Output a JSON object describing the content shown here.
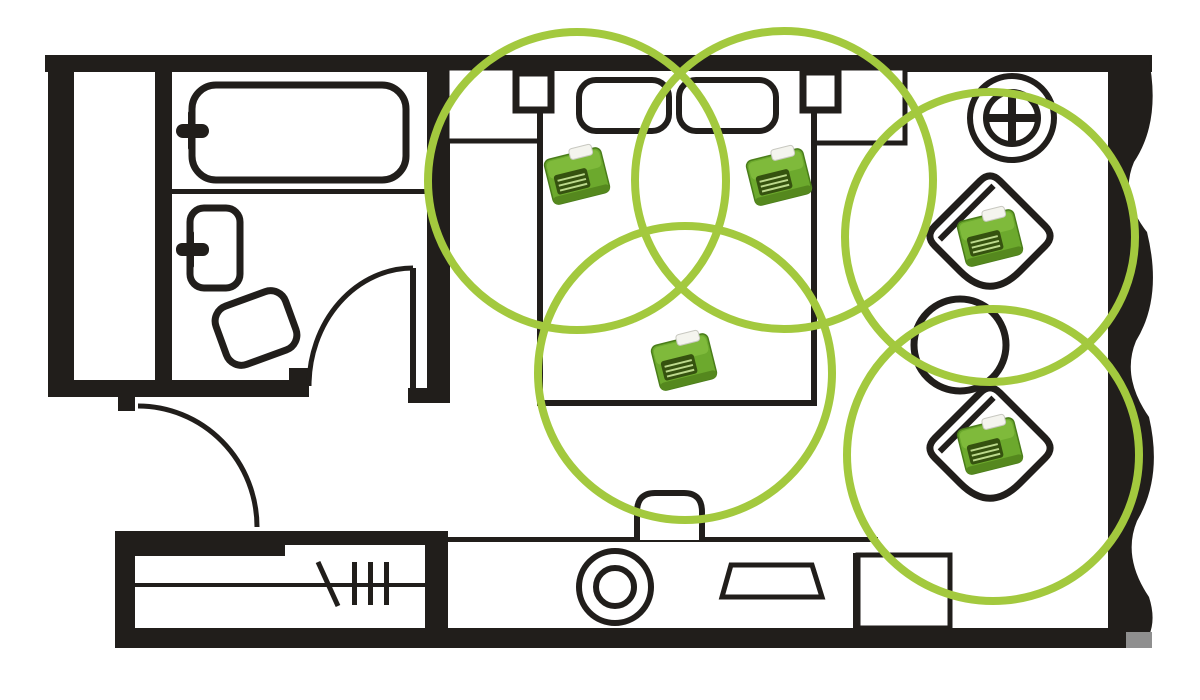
{
  "meta": {
    "kind": "floorplan-sensor-coverage-diagram"
  },
  "colors": {
    "background": "#ffffff",
    "wall": "#211e1b",
    "line": "#211e1b",
    "coverage": "#a3c93e",
    "shadow": "#8f8f8f"
  },
  "floorplan": {
    "walls": [
      {
        "name": "wall-top",
        "x": 45,
        "y": 55,
        "w": 1107,
        "h": 17
      },
      {
        "name": "wall-left",
        "x": 48,
        "y": 55,
        "w": 26,
        "h": 342
      },
      {
        "name": "wall-closet-inner",
        "x": 155,
        "y": 70,
        "w": 17,
        "h": 327
      },
      {
        "name": "wall-bath-bottom",
        "x": 48,
        "y": 380,
        "w": 261,
        "h": 17
      },
      {
        "name": "wall-bath-door-jamb",
        "x": 289,
        "y": 368,
        "w": 20,
        "h": 29
      },
      {
        "name": "wall-bath-bedroom",
        "x": 427,
        "y": 70,
        "w": 23,
        "h": 333
      },
      {
        "name": "wall-bath-bedroom-foot",
        "x": 408,
        "y": 388,
        "w": 42,
        "h": 15
      },
      {
        "name": "wall-entry-door-hinge",
        "x": 118,
        "y": 396,
        "w": 17,
        "h": 15
      },
      {
        "name": "wall-wardrobe-top-thick",
        "x": 115,
        "y": 531,
        "w": 170,
        "h": 25
      },
      {
        "name": "wall-wardrobe-top-thin",
        "x": 285,
        "y": 531,
        "w": 148,
        "h": 14
      },
      {
        "name": "wall-wardrobe-left",
        "x": 115,
        "y": 531,
        "w": 20,
        "h": 117
      },
      {
        "name": "wall-wardrobe-right",
        "x": 425,
        "y": 531,
        "w": 23,
        "h": 117
      },
      {
        "name": "wall-bottom",
        "x": 115,
        "y": 628,
        "w": 1030,
        "h": 20
      },
      {
        "name": "wall-right-wavy",
        "path": "M 1108 55 L 1148 55 Q 1162 120 1134 162 Q 1119 197 1147 232 Q 1163 297 1136 341 Q 1121 377 1149 417 Q 1163 477 1137 521 Q 1122 557 1149 597 Q 1159 628 1141 648 L 1108 648 Z"
      },
      {
        "name": "wall-bottom-end-shadow",
        "x": 1126,
        "y": 632,
        "w": 26,
        "h": 16,
        "fill": "#8f8f8f"
      }
    ],
    "fixtures": [
      {
        "name": "bathtub",
        "type": "rect",
        "x": 192,
        "y": 85,
        "w": 214,
        "h": 95,
        "rx": 24,
        "sw": 7,
        "fill": "#ffffff"
      },
      {
        "name": "bathtub-faucet-handle-icon",
        "type": "bar",
        "x": 176,
        "y": 124,
        "w": 33,
        "h": 14,
        "rx": 7
      },
      {
        "name": "bathtub-faucet-stem-icon",
        "type": "bar",
        "x": 188,
        "y": 111,
        "w": 6,
        "h": 39,
        "rx": 2
      },
      {
        "name": "bathroom-divider-line",
        "type": "bar",
        "x": 172,
        "y": 189,
        "w": 256,
        "h": 5
      },
      {
        "name": "sink",
        "type": "rect",
        "x": 190,
        "y": 208,
        "w": 50,
        "h": 80,
        "rx": 14,
        "sw": 7,
        "fill": "#ffffff"
      },
      {
        "name": "sink-faucet-handle-icon",
        "type": "bar",
        "x": 176,
        "y": 243,
        "w": 33,
        "h": 13,
        "rx": 6
      },
      {
        "name": "sink-faucet-stem-icon",
        "type": "bar",
        "x": 188,
        "y": 231,
        "w": 6,
        "h": 37,
        "rx": 2
      },
      {
        "name": "toilet",
        "type": "rect",
        "x": -37,
        "y": -31,
        "w": 74,
        "h": 62,
        "rx": 16,
        "sw": 7,
        "fill": "#ffffff",
        "transform": "translate(256,328) rotate(-20)"
      },
      {
        "name": "bathroom-door-leaf",
        "type": "bar",
        "x": 410,
        "y": 268,
        "w": 6,
        "h": 120
      },
      {
        "name": "bathroom-door-swing-arc",
        "type": "path",
        "d": "M 309 386 A 104 118 0 0 1 413 268",
        "sw": 5
      },
      {
        "name": "entry-door-swing-arc",
        "type": "path",
        "d": "M 138 406 A 119 121 0 0 1 257 527",
        "sw": 5
      },
      {
        "name": "headboard-ledge-left",
        "type": "rect",
        "x": 447,
        "y": 68,
        "w": 93,
        "h": 73,
        "sw": 5,
        "fill": "#ffffff"
      },
      {
        "name": "headboard-ledge-right",
        "type": "rect",
        "x": 813,
        "y": 68,
        "w": 92,
        "h": 75,
        "sw": 5,
        "fill": "#ffffff"
      },
      {
        "name": "bed",
        "type": "rect",
        "x": 540,
        "y": 68,
        "w": 274,
        "h": 335,
        "sw": 6,
        "fill": "#ffffff"
      },
      {
        "name": "pillow-left",
        "type": "rect",
        "x": 579,
        "y": 80,
        "w": 90,
        "h": 51,
        "rx": 17,
        "sw": 6,
        "fill": "#ffffff"
      },
      {
        "name": "pillow-right",
        "type": "rect",
        "x": 679,
        "y": 80,
        "w": 97,
        "h": 51,
        "rx": 17,
        "sw": 6,
        "fill": "#ffffff"
      },
      {
        "name": "nightstand-left",
        "type": "rect",
        "x": 516,
        "y": 73,
        "w": 35,
        "h": 37,
        "sw": 7,
        "fill": "#ffffff"
      },
      {
        "name": "nightstand-right",
        "type": "rect",
        "x": 803,
        "y": 72,
        "w": 35,
        "h": 38,
        "sw": 7,
        "fill": "#ffffff"
      },
      {
        "name": "floor-lamp-outer-icon",
        "type": "circle",
        "cx": 1012,
        "cy": 118,
        "r": 42,
        "sw": 6,
        "fill": "#ffffff"
      },
      {
        "name": "floor-lamp-inner-icon",
        "type": "circle",
        "cx": 1012,
        "cy": 118,
        "r": 26,
        "sw": 6
      },
      {
        "name": "floor-lamp-cross-h-icon",
        "type": "bar",
        "x": 989,
        "y": 114,
        "w": 46,
        "h": 8
      },
      {
        "name": "floor-lamp-cross-v-icon",
        "type": "bar",
        "x": 1008,
        "y": 95,
        "w": 8,
        "h": 46
      },
      {
        "name": "armchair-top-body",
        "type": "path",
        "d": "M -32 -46 L 32 -46 Q 46 -46 46 -32 L 46 4 Q 46 46 4 46 L -32 46 Q -46 46 -46 32 L -46 -32 Q -46 -46 -32 -46 Z",
        "sw": 7,
        "fill": "#ffffff",
        "transform": "translate(990,236) rotate(45)"
      },
      {
        "name": "armchair-top-backrest",
        "type": "path",
        "d": "M -33 -38 L -33 38",
        "sw": 6,
        "transform": "translate(990,236) rotate(45)"
      },
      {
        "name": "side-table",
        "type": "circle",
        "cx": 960,
        "cy": 345,
        "r": 46,
        "sw": 7,
        "fill": "#ffffff"
      },
      {
        "name": "armchair-bottom-body",
        "type": "path",
        "d": "M -32 -46 L 32 -46 Q 46 -46 46 -32 L 46 4 Q 46 46 4 46 L -32 46 Q -46 46 -46 32 L -46 -32 Q -46 -46 -32 -46 Z",
        "sw": 7,
        "fill": "#ffffff",
        "transform": "translate(990,448) rotate(45)"
      },
      {
        "name": "armchair-bottom-backrest",
        "type": "path",
        "d": "M -33 -38 L -33 38",
        "sw": 6,
        "transform": "translate(990,448) rotate(45)"
      },
      {
        "name": "console-top-line",
        "type": "bar",
        "x": 433,
        "y": 537,
        "w": 445,
        "h": 5
      },
      {
        "name": "bed-foot-bench",
        "type": "path",
        "d": "M 637 540 L 637 512 Q 637 493 655 493 L 684 493 Q 702 493 702 512 L 702 540",
        "sw": 6,
        "fill": "#ffffff"
      },
      {
        "name": "console-right-edge",
        "type": "bar",
        "x": 853,
        "y": 553,
        "w": 5,
        "h": 77
      },
      {
        "name": "stool-outer-icon",
        "type": "circle",
        "cx": 615,
        "cy": 587,
        "r": 36,
        "sw": 6,
        "fill": "#ffffff"
      },
      {
        "name": "stool-inner-icon",
        "type": "circle",
        "cx": 615,
        "cy": 587,
        "r": 19,
        "sw": 6
      },
      {
        "name": "tv-icon",
        "type": "path",
        "d": "M 731 565 L 812 565 L 822 597 L 722 597 Z",
        "sw": 5,
        "fill": "#ffffff"
      },
      {
        "name": "side-unit",
        "type": "rect",
        "x": 858,
        "y": 555,
        "w": 92,
        "h": 73,
        "sw": 5,
        "fill": "#ffffff"
      },
      {
        "name": "wardrobe-rod",
        "type": "bar",
        "x": 135,
        "y": 583,
        "w": 290,
        "h": 4
      },
      {
        "name": "hanger-slash-icon",
        "type": "path",
        "d": "M 318 562 L 338 606",
        "sw": 5
      },
      {
        "name": "hanger-tick-1-icon",
        "type": "bar",
        "x": 352,
        "y": 562,
        "w": 5,
        "h": 43
      },
      {
        "name": "hanger-tick-2-icon",
        "type": "bar",
        "x": 368,
        "y": 562,
        "w": 5,
        "h": 43
      },
      {
        "name": "hanger-tick-3-icon",
        "type": "bar",
        "x": 384,
        "y": 562,
        "w": 5,
        "h": 43
      }
    ]
  },
  "coverage": {
    "color": "#a3c93e",
    "stroke_width": 8,
    "circles": [
      {
        "name": "coverage-circle-bed-left",
        "cx": 577,
        "cy": 181,
        "r": 149
      },
      {
        "name": "coverage-circle-bed-right",
        "cx": 784,
        "cy": 180,
        "r": 149
      },
      {
        "name": "coverage-circle-bed-foot",
        "cx": 685,
        "cy": 373,
        "r": 147
      },
      {
        "name": "coverage-circle-armchair-top",
        "cx": 990,
        "cy": 237,
        "r": 145
      },
      {
        "name": "coverage-circle-armchair-bottom",
        "cx": 993,
        "cy": 455,
        "r": 146
      }
    ]
  },
  "devices": {
    "style": {
      "rotation": -14,
      "body": "#6ca92d",
      "body_top": "#7fba3b",
      "edge": "#4a7d1a",
      "tab": "#f4f4ee",
      "tab_edge": "#c8c8c0",
      "grille": "#35520f",
      "stripe": "#bcd98c",
      "shade": "#55881e"
    },
    "items": [
      {
        "name": "sensor-device-bed-left",
        "cx": 577,
        "cy": 176
      },
      {
        "name": "sensor-device-bed-right",
        "cx": 779,
        "cy": 177
      },
      {
        "name": "sensor-device-bed-foot",
        "cx": 684,
        "cy": 362
      },
      {
        "name": "sensor-device-armchair-top",
        "cx": 990,
        "cy": 238
      },
      {
        "name": "sensor-device-armchair-bottom",
        "cx": 990,
        "cy": 446
      }
    ]
  }
}
